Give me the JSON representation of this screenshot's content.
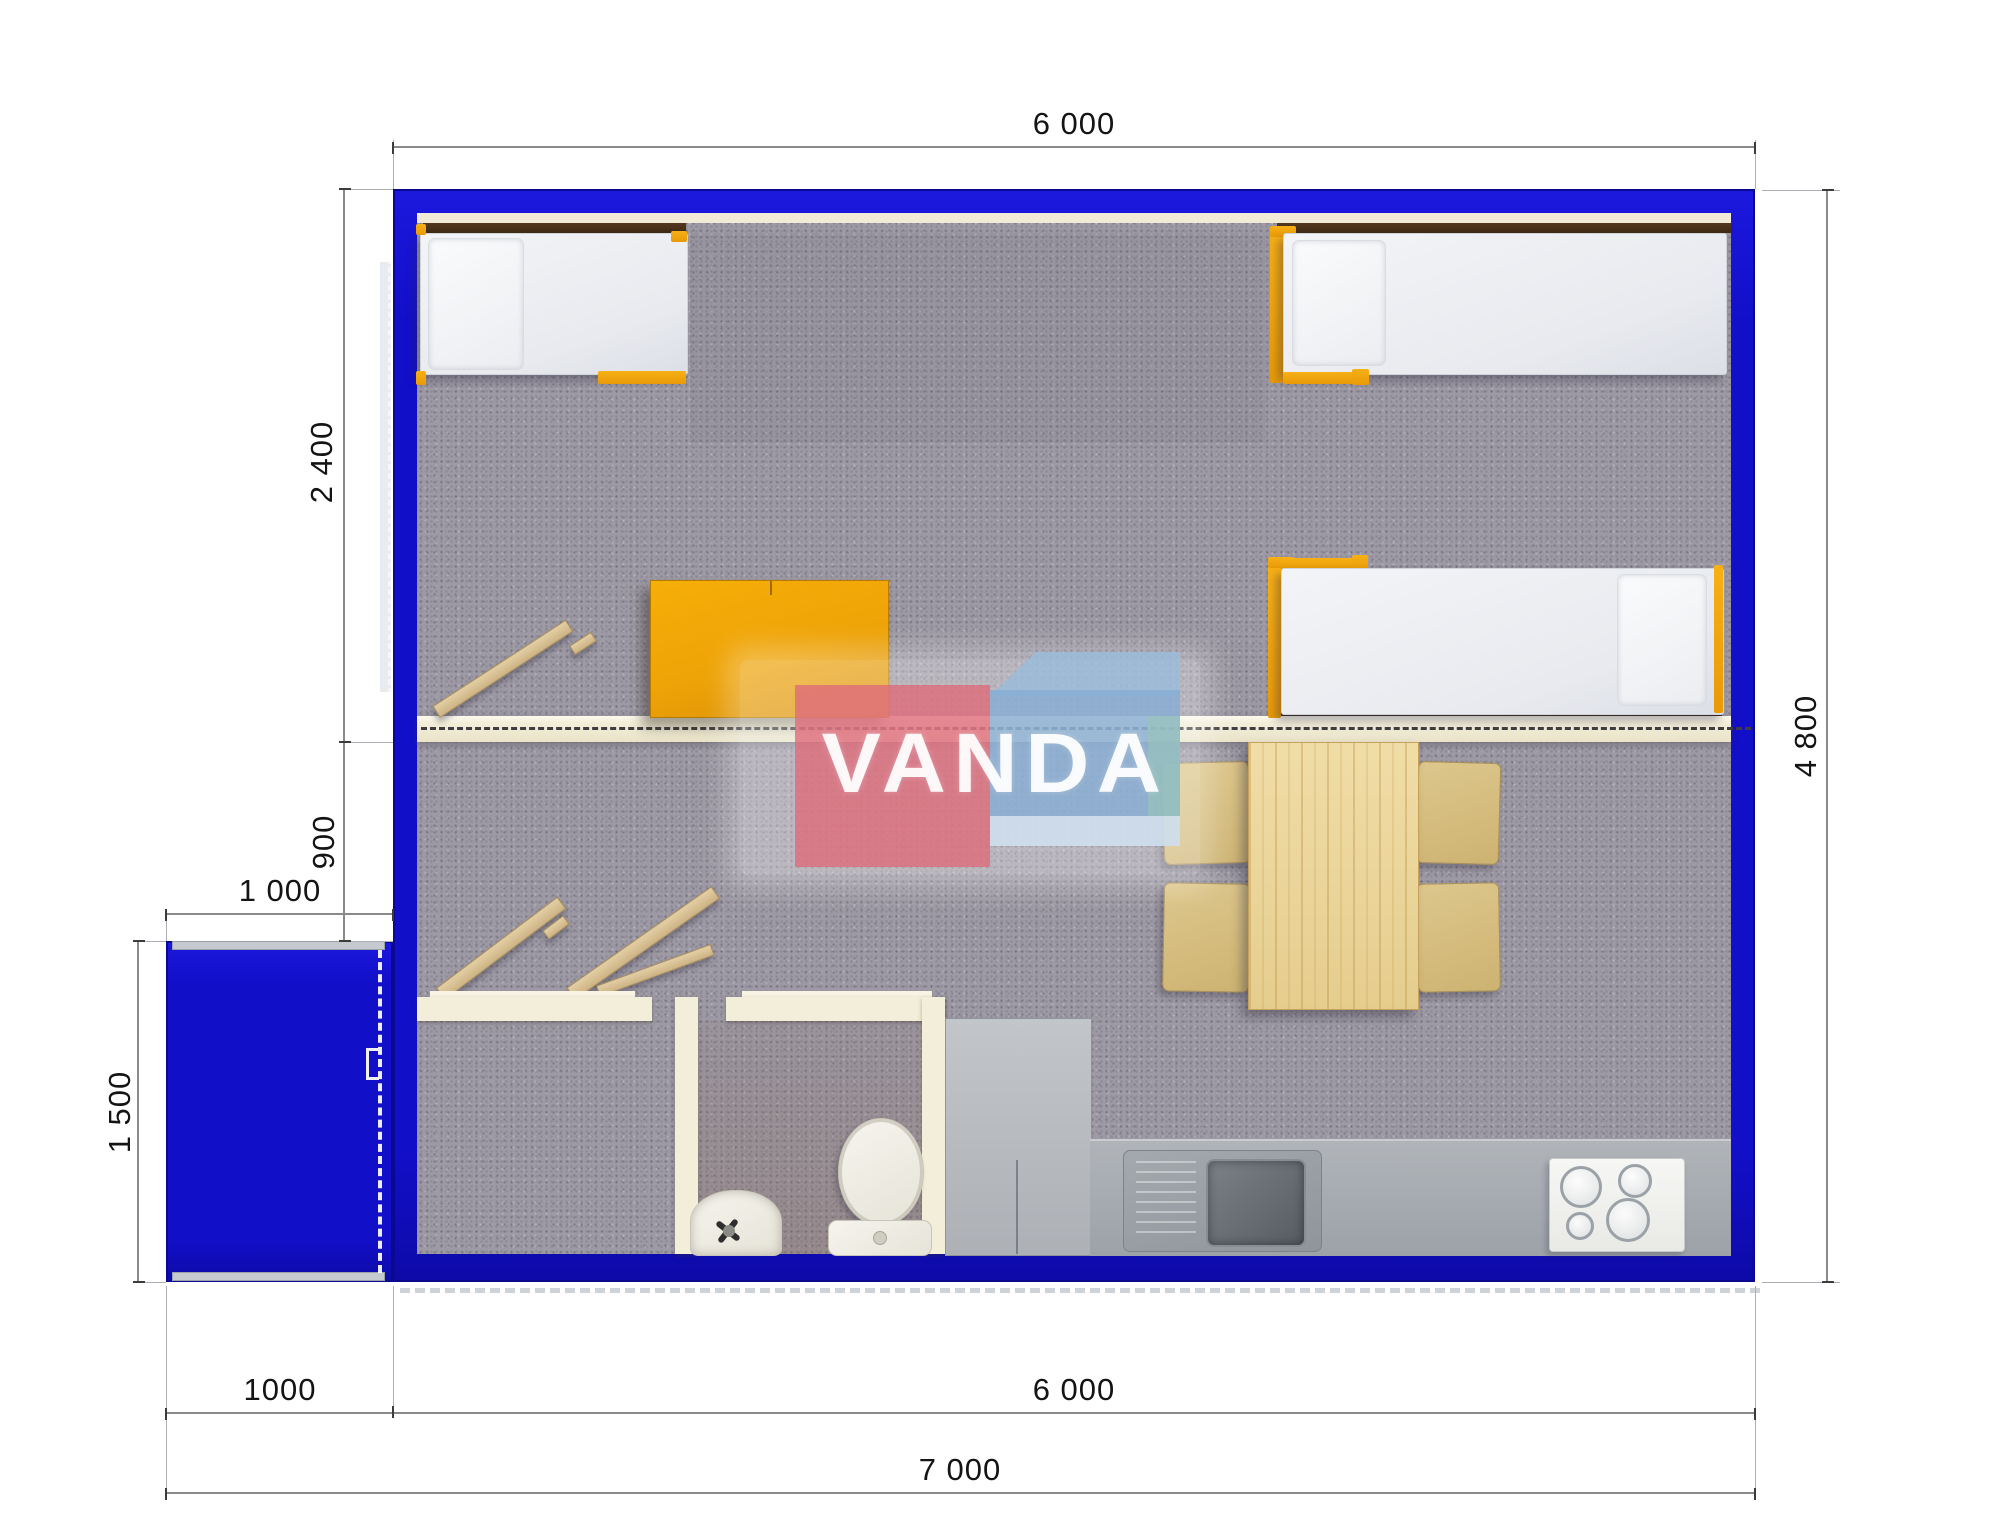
{
  "watermark": {
    "brand": "VANDA"
  },
  "dimensions": {
    "top_width": "6 000",
    "right_height": "4 800",
    "bedroom_depth": "2 400",
    "hall_depth": "900",
    "porch_width_top": "1 000",
    "porch_height": "1 500",
    "porch_width_bottom": "1000",
    "building_width_bottom": "6 000",
    "total_width": "7 000"
  },
  "colors": {
    "wall_blue": "#120fc9",
    "accent_orange": "#efa20c",
    "carpet_gray": "#9e9aa5",
    "partition_cream": "#f3eed9",
    "counter_gray": "#a6aaaf",
    "wood_table": "#ecd79c",
    "watermark_pink": "#df6b7a",
    "watermark_blue": "#88add3"
  }
}
